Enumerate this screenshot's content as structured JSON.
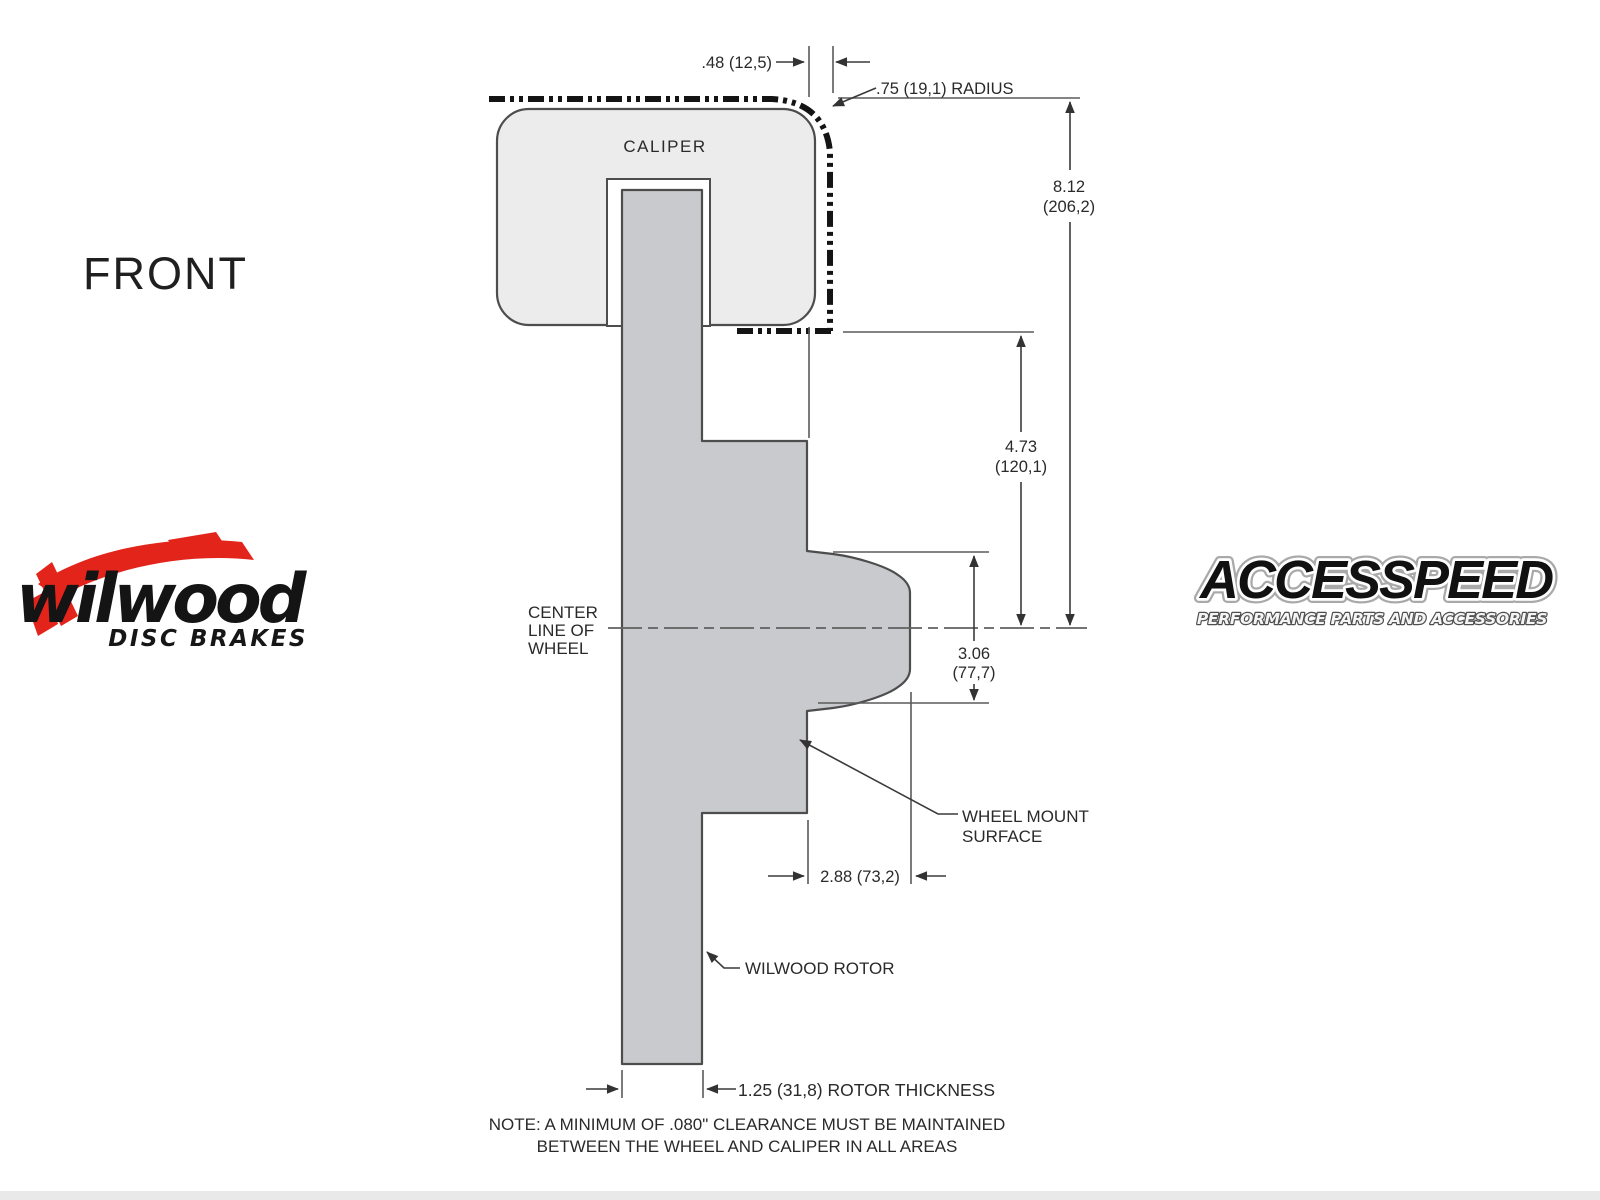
{
  "page": {
    "front_label": "FRONT",
    "footer_bar_color": "#e9e9e9"
  },
  "colors": {
    "wilwood_red": "#e2241b",
    "outline_dark": "#4d4d4d",
    "thin_line": "#5a5a5a",
    "phantom_line": "#141414",
    "caliper_fill": "#ececec",
    "rotor_fill": "#c9cacd",
    "text": "#2a2a2a"
  },
  "diagram": {
    "caliper_label": "CALIPER",
    "centerline": {
      "line1": "CENTER",
      "line2": "LINE OF",
      "line3": "WHEEL"
    },
    "callouts": {
      "wheel_mount_line1": "WHEEL MOUNT",
      "wheel_mount_line2": "SURFACE",
      "rotor": "WILWOOD ROTOR"
    },
    "dimensions": {
      "top_offset": ".48 (12,5)",
      "corner_radius": ".75 (19,1) RADIUS",
      "overall_height_in": "8.12",
      "overall_height_mm": "(206,2)",
      "caliper_to_centerline_in": "4.73",
      "caliper_to_centerline_mm": "(120,1)",
      "flange_height_in": "3.06",
      "flange_height_mm": "(77,7)",
      "mount_depth": "2.88 (73,2)",
      "rotor_thickness": "1.25 (31,8) ROTOR THICKNESS"
    },
    "note_line1": "NOTE: A MINIMUM OF .080\" CLEARANCE MUST BE MAINTAINED",
    "note_line2": "BETWEEN THE WHEEL AND CALIPER IN ALL AREAS"
  },
  "logos": {
    "wilwood": {
      "name": "wilwood",
      "tagline": "DISC BRAKES"
    },
    "accesspeed": {
      "name": "ACCESSPEED",
      "tagline": "PERFORMANCE PARTS AND ACCESSORIES"
    }
  }
}
